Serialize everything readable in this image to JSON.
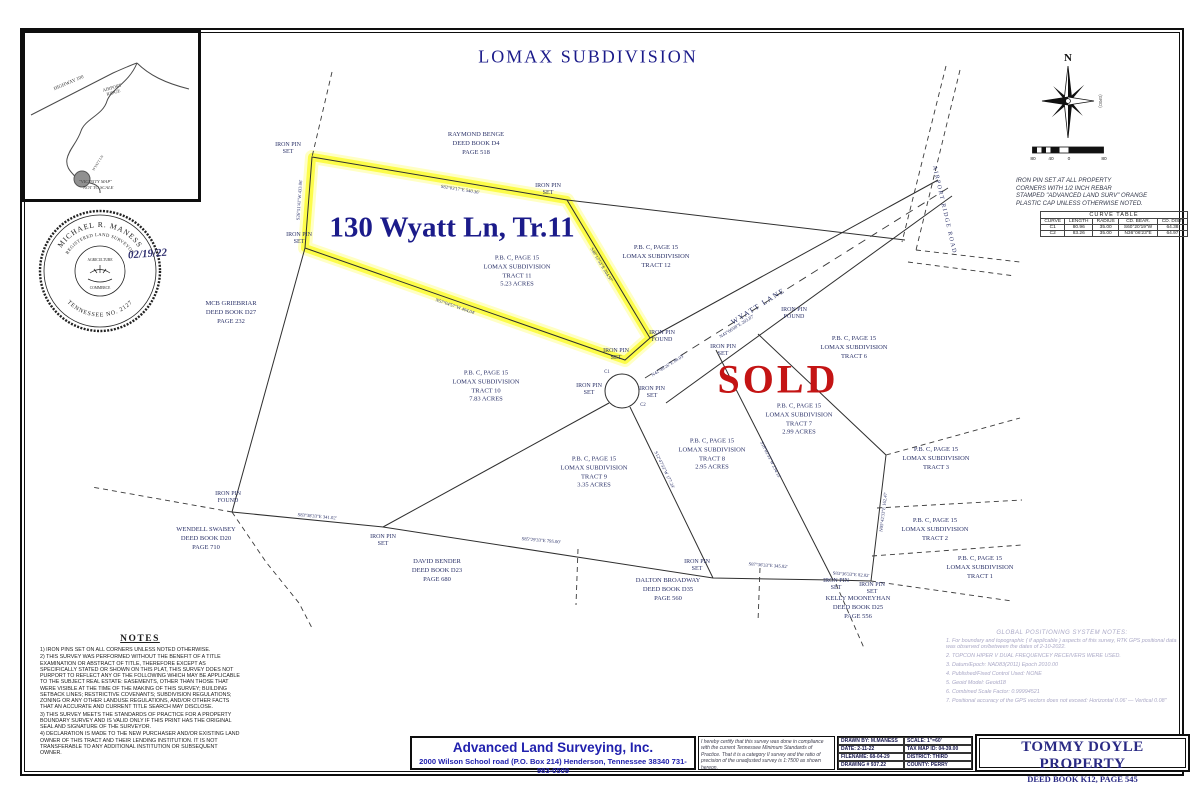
{
  "page": {
    "title": "LOMAX SUBDIVISION"
  },
  "highlight": {
    "label": "130 Wyatt Ln, Tr.11",
    "sold": "SOLD"
  },
  "vicinity": {
    "highway": "HIGHWAY 100",
    "ridge": "AIRPORT\nRIDGE",
    "road": "WYATT LN",
    "caption1": "\"VICINITY MAP\"",
    "caption2": "NOT TO SCALE"
  },
  "seal": {
    "name": "MICHAEL R. MANESS",
    "title": "REGISTERED LAND SURVEYOR",
    "state": "TENNESSEE  NO. 2127",
    "center_top": "AGRICULTURE",
    "center_bottom": "COMMERCE",
    "date": "02/19/22"
  },
  "compass": {
    "north": "N",
    "grid": "(GRID)",
    "ticks": [
      "80",
      "40",
      "0",
      "80"
    ]
  },
  "pin_note": "IRON PIN SET AT ALL PROPERTY\nCORNERS WITH 1/2 INCH REBAR\nSTAMPED \"ADVANCED LAND SURV\" ORANGE\nPLASTIC CAP UNLESS OTHERWISE NOTED.",
  "curve_table": {
    "title": "CURVE TABLE",
    "headers": [
      "CURVE",
      "LENGTH",
      "RADIUS",
      "CD. BEAR.",
      "CD. DIST."
    ],
    "rows": [
      [
        "C1",
        "80.96",
        "35.00",
        "S60°20'19\"W",
        "64.38"
      ],
      [
        "C2",
        "83.26",
        "35.00",
        "N36°06'23\"E",
        "64.97"
      ]
    ]
  },
  "roads": {
    "wyatt": "WYATT LANE",
    "airport": "AIRPORT RIDGE ROAD"
  },
  "tracts": [
    {
      "x": 517,
      "y": 272,
      "lines": [
        "P.B. C, PAGE 15",
        "LOMAX SUBDIVISION",
        "TRACT 11",
        "5.23 ACRES"
      ]
    },
    {
      "x": 656,
      "y": 257,
      "lines": [
        "P.B. C, PAGE 15",
        "LOMAX SUBDIVISION",
        "TRACT 12"
      ]
    },
    {
      "x": 486,
      "y": 387,
      "lines": [
        "P.B. C, PAGE 15",
        "LOMAX SUBDIVISION",
        "TRACT 10",
        "7.83 ACRES"
      ]
    },
    {
      "x": 594,
      "y": 473,
      "lines": [
        "P.B. C, PAGE 15",
        "LOMAX SUBDIVISION",
        "TRACT 9",
        "3.35 ACRES"
      ]
    },
    {
      "x": 712,
      "y": 455,
      "lines": [
        "P.B. C, PAGE 15",
        "LOMAX SUBDIVISION",
        "TRACT 8",
        "2.95 ACRES"
      ]
    },
    {
      "x": 799,
      "y": 420,
      "lines": [
        "P.B. C, PAGE 15",
        "LOMAX SUBDIVISION",
        "TRACT 7",
        "2.99 ACRES"
      ]
    },
    {
      "x": 854,
      "y": 348,
      "lines": [
        "P.B. C, PAGE 15",
        "LOMAX SUBDIVISION",
        "TRACT 6"
      ]
    },
    {
      "x": 936,
      "y": 459,
      "lines": [
        "P.B. C, PAGE 15",
        "LOMAX SUBDIVISION",
        "TRACT 3"
      ]
    },
    {
      "x": 935,
      "y": 530,
      "lines": [
        "P.B. C, PAGE 15",
        "LOMAX SUBDIVISION",
        "TRACT 2"
      ]
    },
    {
      "x": 980,
      "y": 568,
      "lines": [
        "P.B. C, PAGE 15",
        "LOMAX SUBDIVISION",
        "TRACT 1"
      ]
    }
  ],
  "neighbors": [
    {
      "x": 476,
      "y": 144,
      "lines": [
        "RAYMOND BENGE",
        "DEED BOOK D4",
        "PAGE 518"
      ]
    },
    {
      "x": 231,
      "y": 313,
      "lines": [
        "MCB GRIEBRIAR",
        "DEED BOOK D27",
        "PAGE 232"
      ]
    },
    {
      "x": 206,
      "y": 539,
      "lines": [
        "WENDELL SWABEY",
        "DEED BOOK D20",
        "PAGE 710"
      ]
    },
    {
      "x": 437,
      "y": 571,
      "lines": [
        "DAVID BENDER",
        "DEED BOOK D23",
        "PAGE 680"
      ]
    },
    {
      "x": 668,
      "y": 590,
      "lines": [
        "DALTON BROADWAY",
        "DEED BOOK D35",
        "PAGE 560"
      ]
    },
    {
      "x": 858,
      "y": 608,
      "lines": [
        "KELLY MOONEYHAN",
        "DEED BOOK D25",
        "PAGE 556"
      ]
    }
  ],
  "pins": [
    {
      "x": 288,
      "y": 149,
      "label": "IRON PIN\nSET"
    },
    {
      "x": 548,
      "y": 190,
      "label": "IRON PIN\nSET"
    },
    {
      "x": 299,
      "y": 239,
      "label": "IRON PIN\nSET"
    },
    {
      "x": 662,
      "y": 337,
      "label": "IRON PIN\nFOUND"
    },
    {
      "x": 723,
      "y": 351,
      "label": "IRON PIN\nSET"
    },
    {
      "x": 794,
      "y": 314,
      "label": "IRON PIN\nFOUND"
    },
    {
      "x": 589,
      "y": 390,
      "label": "IRON PIN\nSET"
    },
    {
      "x": 652,
      "y": 393,
      "label": "IRON PIN\nSET"
    },
    {
      "x": 616,
      "y": 355,
      "label": "IRON PIN\nSET"
    },
    {
      "x": 228,
      "y": 498,
      "label": "IRON PIN\nFOUND"
    },
    {
      "x": 383,
      "y": 541,
      "label": "IRON PIN\nSET"
    },
    {
      "x": 697,
      "y": 566,
      "label": "IRON PIN\nSET"
    },
    {
      "x": 836,
      "y": 585,
      "label": "IRON PIN\nSET"
    },
    {
      "x": 872,
      "y": 589,
      "label": "IRON PIN\nSET"
    }
  ],
  "bearings": [
    {
      "x": 460,
      "y": 190,
      "a": 9,
      "text": "S82°03'17\"E  540.36'"
    },
    {
      "x": 300,
      "y": 200,
      "a": -86,
      "text": "S26°51'41\"W  433.06'"
    },
    {
      "x": 601,
      "y": 265,
      "a": 59,
      "text": "S48°12'53\"E  204.97'"
    },
    {
      "x": 455,
      "y": 307,
      "a": 19,
      "text": "N57°04'57\"W  404.04'"
    },
    {
      "x": 737,
      "y": 327,
      "a": -32,
      "text": "N43°06'08\"E  203.87'"
    },
    {
      "x": 668,
      "y": 366,
      "a": -32,
      "text": "N42°49'26\"E  88.03'"
    },
    {
      "x": 317,
      "y": 517,
      "a": 5,
      "text": "S83°38'33\"E  341.02'"
    },
    {
      "x": 541,
      "y": 541,
      "a": 5,
      "text": "S85°29'33\"E  795.00'"
    },
    {
      "x": 768,
      "y": 566,
      "a": 4,
      "text": "S87°36'33\"E  345.82'"
    },
    {
      "x": 851,
      "y": 575,
      "a": 4,
      "text": "S83°36'33\"E  82.02'"
    },
    {
      "x": 664,
      "y": 470,
      "a": 64,
      "text": "S12°47'33\"W  177.24'"
    },
    {
      "x": 770,
      "y": 460,
      "a": 63,
      "text": "S18°02'33\"W  234.15'"
    },
    {
      "x": 884,
      "y": 512,
      "a": -83,
      "text": "N05°42'33\"E  162.47'"
    },
    {
      "x": 607,
      "y": 372,
      "a": 0,
      "text": "C1"
    },
    {
      "x": 643,
      "y": 405,
      "a": 0,
      "text": "C2"
    }
  ],
  "notes": {
    "title": "NOTES",
    "items": [
      "1) IRON PINS SET ON ALL CORNERS UNLESS NOTED OTHERWISE.",
      "2) THIS SURVEY WAS PERFORMED WITHOUT THE BENEFIT OF A TITLE EXAMINATION OR ABSTRACT OF TITLE, THEREFORE EXCEPT AS SPECIFICALLY STATED OR SHOWN ON THIS PLAT, THIS SURVEY DOES NOT PURPORT TO REFLECT ANY OF THE FOLLOWING WHICH MAY BE APPLICABLE TO THE SUBJECT REAL ESTATE: EASEMENTS, OTHER THAN THOSE THAT WERE VISIBLE AT THE TIME OF  THE MAKING OF THIS SURVEY; BUILDING SETBACK LINES; RESTRICTIVE COVENANTS; SUBDIVISION REGULATIONS; ZONING OR ANY OTHER LANDUSE REGULATIONS, AND/OR OTHER FACTS THAT AN ACCURATE AND CURRENT  TITLE SEARCH MAY DISCLOSE.",
      "3) THIS SURVEY MEETS THE STANDARDS OF PRACTICE FOR A PROPERTY BOUNDARY SURVEY AND IS VALID ONLY IF THIS PRINT HAS THE ORIGINAL SEAL AND SIGNATURE OF THE SURVEYOR.",
      "4) DECLARATION IS MADE TO THE NEW PURCHASER AND/OR EXISTING LAND OWNER OF THIS TRACT AND  THEIR LENDING INSTITUTION. IT IS NOT TRANSFERABLE TO ANY ADDITIONAL INSTITUTION OR SUBSEQUENT OWNER."
    ]
  },
  "gps": {
    "title": "GLOBAL POSITIONING SYSTEM NOTES:",
    "items": [
      "1.  For boundary and topographic ( if applicable ) aspects of this survey, RTK GPS positional data was observed on/between the dates of 2-10-2022.",
      "2.  TOPCON HIPER V DUAL FREQUENCEY RECEIVERS WERE USED.",
      "3.  Datum/Epoch:  NAD83(2011) Epoch 2010.00",
      "4.  Published/Fixed Control Used:  NONE",
      "5.  Geoid Model:   Geoid18",
      "6.  Combined Scale Factor:  0.99994521",
      "7.  Positional accuracy of the GPS vectors does not exceed: Horizontal 0.06'   —   Vertical 0.08\""
    ]
  },
  "title_block": {
    "company": {
      "name": "Advanced Land Surveying, Inc.",
      "address": "2000 Wilson School road (P.O. Box 214)    Henderson, Tennessee  38340      731-983-0509"
    },
    "certification": "I hereby certify that this survey was done in compliance with the current Tennessee Minimum Standards of Practice. That it is a category II survey and the ratio of precision of the unadjusted survey is 1:7500 as shown hereon.",
    "fields_left": [
      "DRAWN BY: M.MANESS",
      "DATE: 2-11-22",
      "FILENAME: 68-04-29",
      "DRAWING # 937.22"
    ],
    "fields_right": [
      "SCALE: 1\"=60'",
      "TAX MAP ID: 04-39.00",
      "DISTRICT: THIRD",
      "COUNTY: PERRY"
    ],
    "property": {
      "name": "TOMMY DOYLE PROPERTY",
      "deed": "DEED BOOK K12, PAGE 545"
    }
  }
}
